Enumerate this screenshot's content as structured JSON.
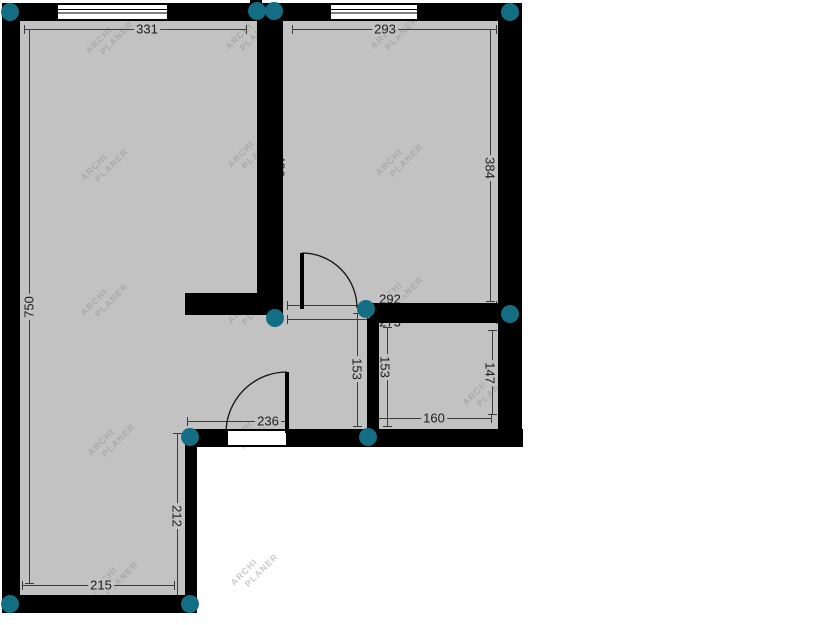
{
  "app": {
    "watermark_line1": "ARCHI",
    "watermark_line2": "PLANER"
  },
  "colors": {
    "background": "#ffffff",
    "room_fill": "#c2c2c2",
    "wall": "#000000",
    "handle_teal": "#136e83",
    "dim_line": "#3c3c3c",
    "dim_text": "#1c1c1c",
    "watermark": "#8e8e8e"
  },
  "canvas": {
    "width": 825,
    "height": 625
  },
  "rooms": [
    {
      "name": "room-area-main",
      "x": 20,
      "y": 21,
      "w": 480,
      "h": 408
    },
    {
      "name": "room-area-lower-left",
      "x": 20,
      "y": 429,
      "w": 177,
      "h": 166
    }
  ],
  "walls": [
    {
      "name": "wall-top",
      "x": 2,
      "y": 3,
      "w": 520,
      "h": 18
    },
    {
      "name": "wall-left",
      "x": 2,
      "y": 3,
      "w": 18,
      "h": 610
    },
    {
      "name": "wall-right",
      "x": 498,
      "y": 3,
      "w": 24,
      "h": 444
    },
    {
      "name": "wall-middle-vertical",
      "x": 257,
      "y": 3,
      "w": 26,
      "h": 312
    },
    {
      "name": "wall-stub-left",
      "x": 185,
      "y": 293,
      "w": 77,
      "h": 22
    },
    {
      "name": "wall-middle-horizontal",
      "x": 370,
      "y": 303,
      "w": 130,
      "h": 20
    },
    {
      "name": "wall-lower-vertical",
      "x": 367,
      "y": 318,
      "w": 12,
      "h": 111
    },
    {
      "name": "wall-bottom-middle",
      "x": 185,
      "y": 429,
      "w": 338,
      "h": 18
    },
    {
      "name": "wall-lowerroom-right",
      "x": 185,
      "y": 429,
      "w": 12,
      "h": 184
    },
    {
      "name": "wall-bottom",
      "x": 2,
      "y": 595,
      "w": 195,
      "h": 18
    },
    {
      "name": "wall-notch-top",
      "x": 250,
      "y": 0,
      "w": 12,
      "h": 4
    }
  ],
  "openings": [
    {
      "name": "window-top-left",
      "type": "window",
      "x": 57,
      "y": 4,
      "w": 111,
      "h": 16
    },
    {
      "name": "window-top-right",
      "type": "window",
      "x": 330,
      "y": 4,
      "w": 88,
      "h": 16
    },
    {
      "name": "door-opening-bottom",
      "type": "opening",
      "x": 227,
      "y": 430,
      "w": 60,
      "h": 16
    }
  ],
  "doors": [
    {
      "name": "door-swing-hall",
      "leaf": {
        "x": 300,
        "y": 253,
        "w": 4,
        "h": 56
      },
      "arc": "M302,253 A55,55 0 0 1 357,308"
    },
    {
      "name": "door-swing-bottom",
      "leaf": {
        "x": 285,
        "y": 372,
        "w": 4,
        "h": 61
      },
      "arc": "M287,372 A61,61 0 0 0 226,433"
    }
  ],
  "handles": [
    [
      10,
      12
    ],
    [
      257,
      11
    ],
    [
      274,
      11
    ],
    [
      510,
      12
    ],
    [
      510,
      314
    ],
    [
      275,
      318
    ],
    [
      366,
      309
    ],
    [
      190,
      437
    ],
    [
      368,
      437
    ],
    [
      10,
      604
    ],
    [
      190,
      604
    ]
  ],
  "dimensions": [
    {
      "label": "331",
      "orient": "h",
      "x": 24,
      "y": 29,
      "len": 223,
      "lx": 147,
      "ly": 29,
      "rot": 0
    },
    {
      "label": "293",
      "orient": "h",
      "x": 292,
      "y": 29,
      "len": 205,
      "lx": 385,
      "ly": 29,
      "rot": 0
    },
    {
      "label": "750",
      "orient": "v",
      "x": 29,
      "y": 29,
      "len": 555,
      "lx": 29,
      "ly": 307,
      "rot": -90
    },
    {
      "label": "384",
      "orient": "v",
      "x": 490,
      "y": 29,
      "len": 273,
      "lx": 490,
      "ly": 168,
      "rot": 90
    },
    {
      "label": "486",
      "orient": "v",
      "x": 283,
      "y": 60,
      "len": 0,
      "lx": 280,
      "ly": 166,
      "rot": 90
    },
    {
      "label": "292",
      "orient": "h",
      "x": 287,
      "y": 305,
      "len": 210,
      "lx": 390,
      "ly": 299,
      "rot": 0
    },
    {
      "label": "273",
      "orient": "h",
      "x": 287,
      "y": 319,
      "len": 210,
      "lx": 390,
      "ly": 322,
      "rot": 0
    },
    {
      "label": "153",
      "orient": "v",
      "x": 357,
      "y": 313,
      "len": 114,
      "lx": 357,
      "ly": 369,
      "rot": 90
    },
    {
      "label": "153",
      "orient": "v",
      "x": 387,
      "y": 327,
      "len": 100,
      "lx": 385,
      "ly": 367,
      "rot": 90
    },
    {
      "label": "147",
      "orient": "v",
      "x": 492,
      "y": 330,
      "len": 85,
      "lx": 490,
      "ly": 373,
      "rot": 90
    },
    {
      "label": "160",
      "orient": "h",
      "x": 377,
      "y": 418,
      "len": 115,
      "lx": 434,
      "ly": 418,
      "rot": 0
    },
    {
      "label": "236",
      "orient": "h",
      "x": 187,
      "y": 421,
      "len": 101,
      "lx": 268,
      "ly": 421,
      "rot": 0
    },
    {
      "label": "212",
      "orient": "v",
      "x": 177,
      "y": 433,
      "len": 163,
      "lx": 177,
      "ly": 516,
      "rot": 90
    },
    {
      "label": "215",
      "orient": "h",
      "x": 22,
      "y": 585,
      "len": 153,
      "lx": 101,
      "ly": 585,
      "rot": 0
    }
  ],
  "watermarks": [
    [
      110,
      38
    ],
    [
      250,
      34
    ],
    [
      395,
      33
    ],
    [
      105,
      165
    ],
    [
      252,
      152
    ],
    [
      400,
      160
    ],
    [
      105,
      300
    ],
    [
      252,
      308
    ],
    [
      400,
      293
    ],
    [
      112,
      440
    ],
    [
      250,
      432
    ],
    [
      487,
      390
    ],
    [
      115,
      578
    ],
    [
      255,
      570
    ]
  ]
}
